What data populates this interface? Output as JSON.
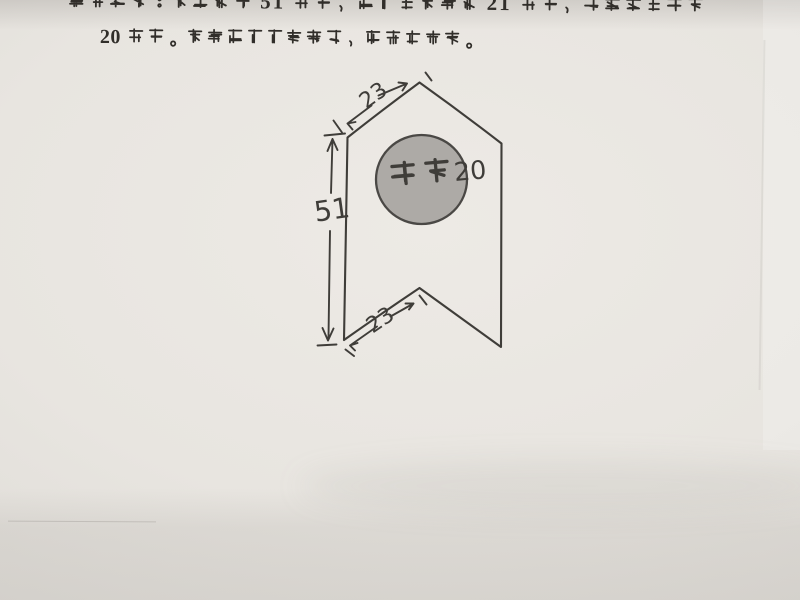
{
  "colors": {
    "paper": "#e8e5e0",
    "ink_print": "#312e2a",
    "ink_hand": "#3f3d39",
    "circle_fill": "#adaaa6",
    "circle_stroke": "#4a4845"
  },
  "document": {
    "line1_cropped": "尺寸如图：两竖边长 51 毫米，三角形两个边 21 毫米，中间圆形直径",
    "line2": "20 毫米。两个三角角度随意，但是要一样。"
  },
  "diagram": {
    "circle_label": "直径20",
    "left_edge_mm": "51",
    "top_edge_mm": "23",
    "bottom_edge_mm": "23"
  }
}
